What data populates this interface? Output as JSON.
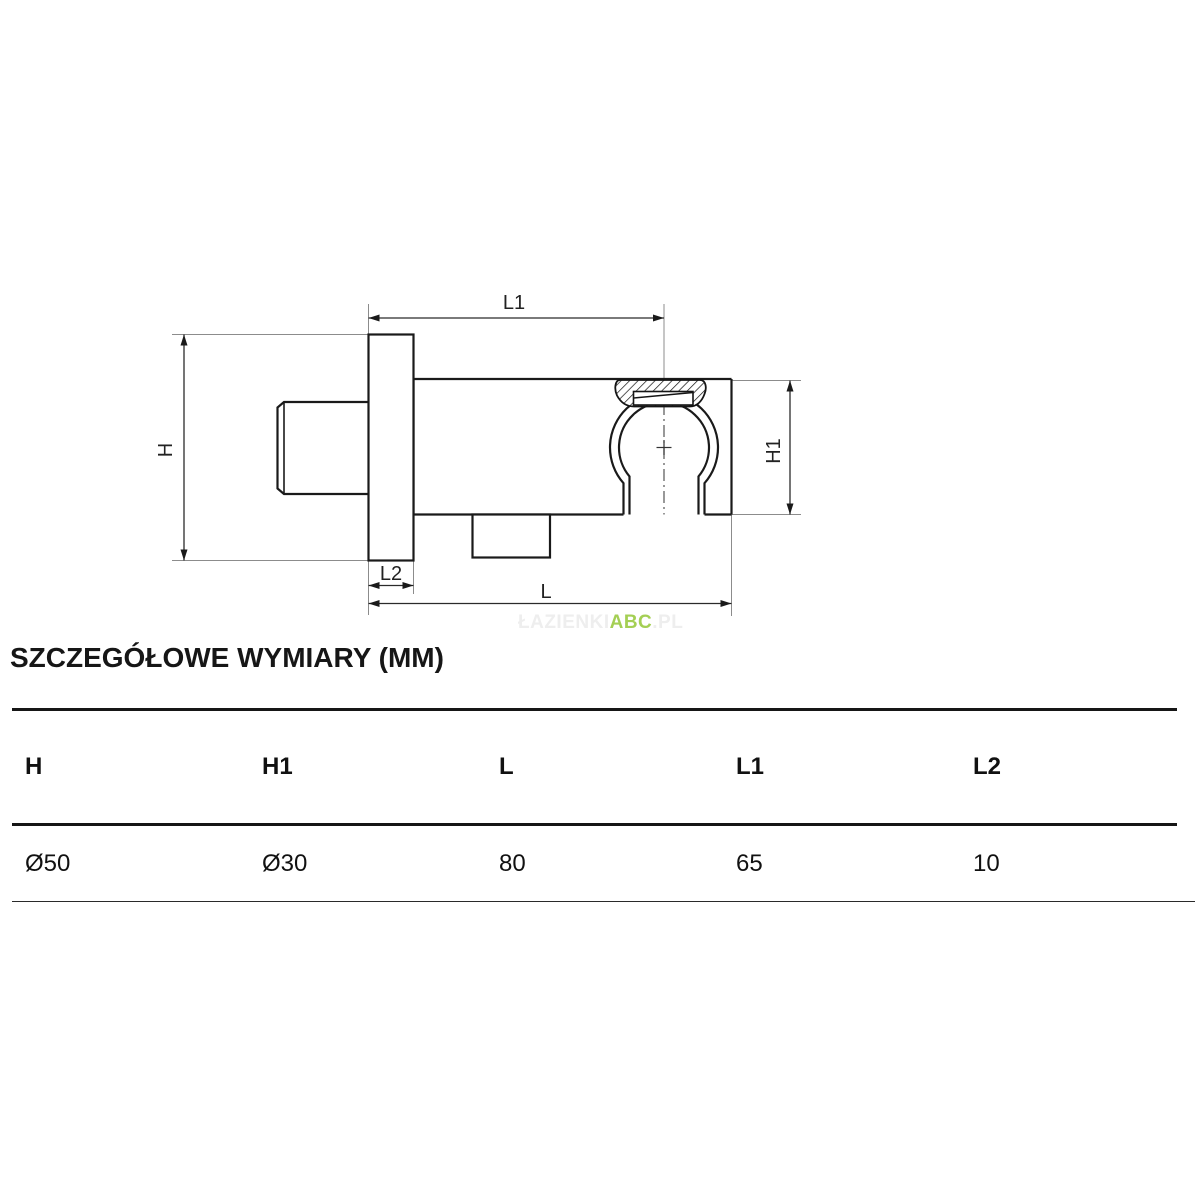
{
  "section": {
    "title": "SZCZEGÓŁOWE WYMIARY (MM)"
  },
  "drawing": {
    "labels": {
      "H": "H",
      "H1": "H1",
      "L": "L",
      "L1": "L1",
      "L2": "L2"
    }
  },
  "table": {
    "columns": [
      "H",
      "H1",
      "L",
      "L1",
      "L2"
    ],
    "values": [
      "Ø50",
      "Ø30",
      "80",
      "65",
      "10"
    ]
  },
  "watermark": {
    "prefix": "ŁAZIENKI",
    "highlight": "ABC",
    "suffix": ".PL",
    "highlight_color": "#a4cf54",
    "faint_color": "#eeeeee"
  }
}
